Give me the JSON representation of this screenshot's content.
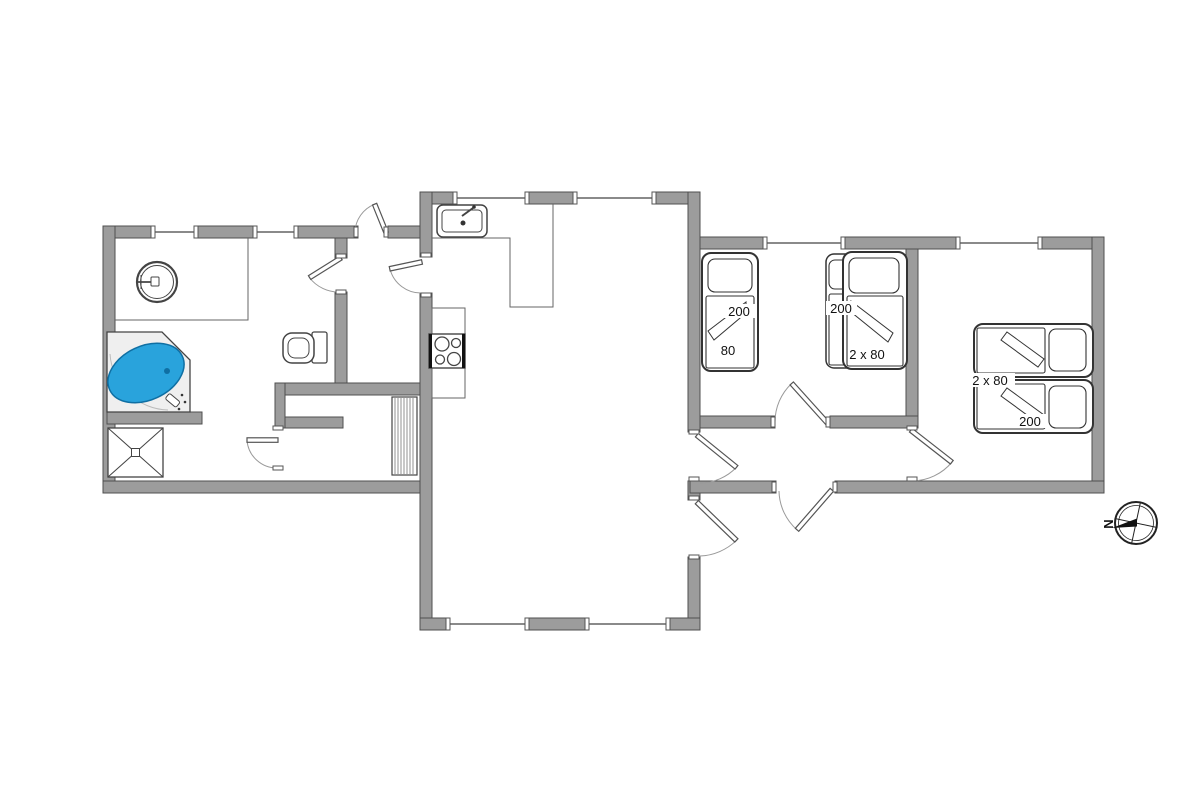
{
  "title": "Holiday home floor plan",
  "colors": {
    "wall": "#9c9c9c",
    "wall_edge": "#4f4f4f",
    "tub": "#29a3dc",
    "tub_edge": "#0f6fa3"
  },
  "beds": {
    "single": {
      "length": "200",
      "width": "80"
    },
    "twin": {
      "length": "200",
      "width": "2 x 80"
    },
    "master": {
      "width": "2 x 80",
      "length": "200"
    }
  },
  "compass": {
    "north": "N"
  },
  "fixtures": [
    "washbasin",
    "jacuzzi",
    "shower",
    "toilet",
    "kitchen-sink",
    "stove",
    "stairs"
  ]
}
